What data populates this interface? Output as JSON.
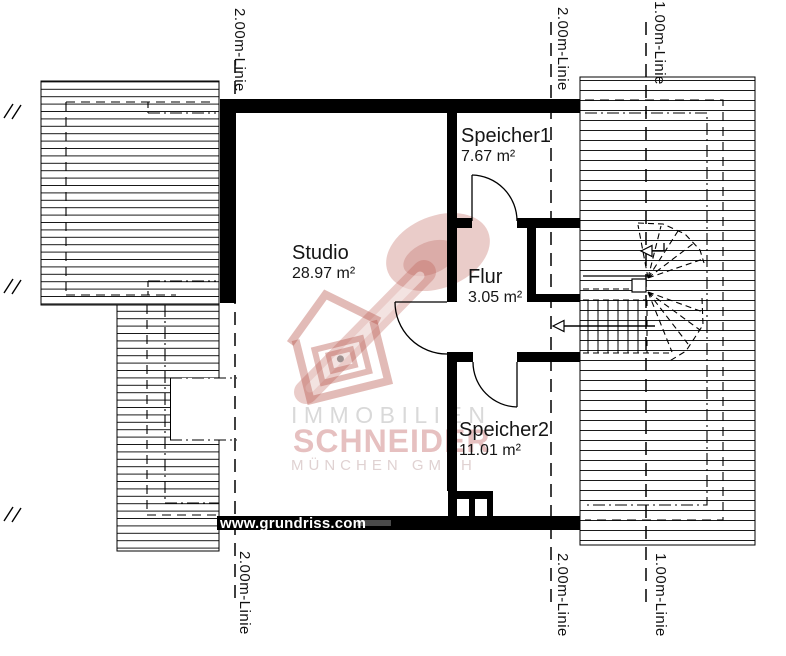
{
  "plan": {
    "rooms": {
      "studio": {
        "name": "Studio",
        "area": "28.97 m²"
      },
      "speicher1": {
        "name": "Speicher1",
        "area": "7.67 m²"
      },
      "flur": {
        "name": "Flur",
        "area": "3.05 m²"
      },
      "speicher2": {
        "name": "Speicher2",
        "area": "11.01 m²"
      }
    },
    "height_lines": {
      "two_meter": "2.00m-Linie",
      "one_meter": "1.00m-Linie"
    }
  },
  "watermark": {
    "line1": "IMMOBILIEN",
    "line2": "SCHNEIDER",
    "line3": "MÜNCHEN GMBH"
  },
  "footer": {
    "website": "www.grundriss.com"
  },
  "colors": {
    "ink": "#000000",
    "background": "#ffffff",
    "watermark_gray": "#d9d9d9",
    "watermark_red": "#e6c0c0",
    "logo_red": "#b85648"
  }
}
